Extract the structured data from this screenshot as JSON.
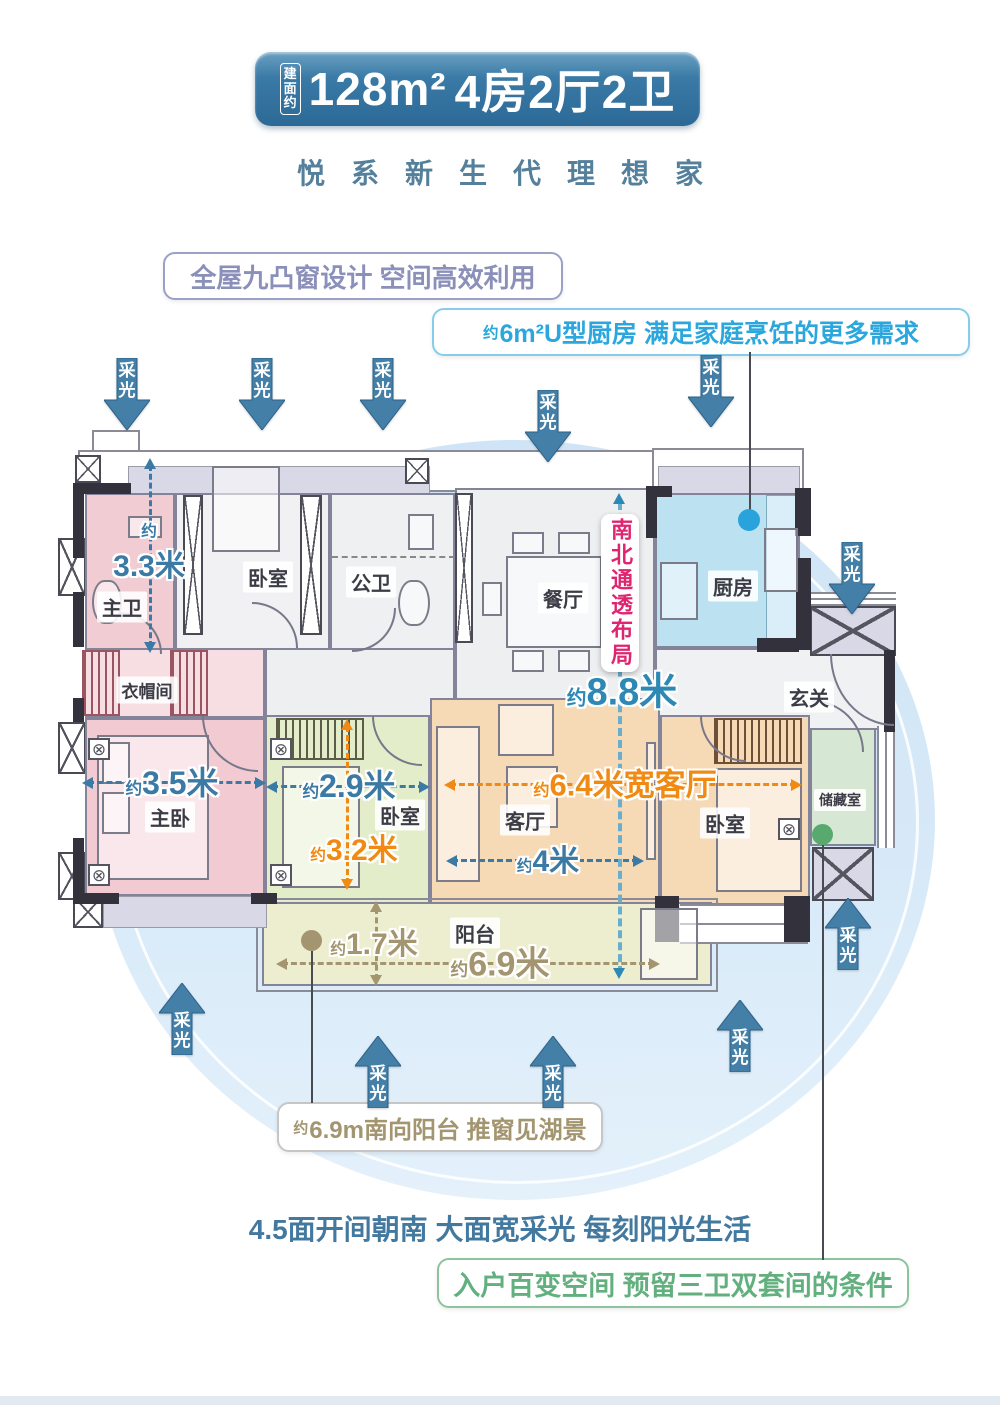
{
  "header": {
    "badge_prefix": "建面约",
    "badge_area": "128m²",
    "badge_suffix": "4房2厅2卫",
    "subtitle": "悦系新生代理想家"
  },
  "callouts": {
    "windows": "全屋九凸窗设计 空间高效利用",
    "kitchen_prefix": "约",
    "kitchen_text": "6m²U型厨房 满足家庭烹饪的更多需求",
    "ns_layout": "南北通透布局",
    "balcony_prefix": "约",
    "balcony_text": "6.9m南向阳台 推窗见湖景",
    "south": "4.5面开间朝南 大面宽采光 每刻阳光生活",
    "entry": "入户百变空间 预留三卫双套间的条件"
  },
  "daylight_label": "采光",
  "rooms": {
    "master_bath": "主卫",
    "cloakroom": "衣帽间",
    "master_bedroom": "主卧",
    "bedroom2": "卧室",
    "public_bath": "公卫",
    "dining": "餐厅",
    "kitchen": "厨房",
    "entry": "玄关",
    "bedroom3": "卧室",
    "living": "客厅",
    "bedroom4": "卧室",
    "storage": "储藏室",
    "balcony": "阳台"
  },
  "dimensions": {
    "d33": {
      "prefix": "约",
      "value": "3.3米"
    },
    "d35": {
      "prefix": "约",
      "value": "3.5米"
    },
    "d29": {
      "prefix": "约",
      "value": "2.9米"
    },
    "d32": {
      "prefix": "约",
      "value": "3.2米"
    },
    "d64": {
      "prefix": "约",
      "value": "6.4米宽客厅"
    },
    "d4": {
      "prefix": "约",
      "value": "4米"
    },
    "d88": {
      "prefix": "约",
      "value": "8.8米"
    },
    "d17": {
      "prefix": "约",
      "value": "1.7米"
    },
    "d69": {
      "prefix": "约",
      "value": "6.9米"
    }
  },
  "colors": {
    "badge_blue": "#2c6997",
    "subtitle_teal": "#55809b",
    "windows_purple": "#8b90bb",
    "kitchen_cyan": "#2ba7dd",
    "ns_red": "#e02570",
    "daylight_arrow": "#447fa7",
    "dim_blue": "#3b7aa5",
    "dim_orange": "#f08a12",
    "dim_teal": "#2d89b3",
    "dim_tan": "#a3956f",
    "south_blue": "#44799f",
    "entry_green": "#63b07f",
    "glow_blue": "#d2e5f5",
    "room_pink": "#f1cad2",
    "room_green": "#e4edca",
    "room_tan": "#f6d9b5",
    "room_kitchen_blue": "#bce1f1",
    "room_storage_green": "#d6e8d3",
    "room_balcony": "#ededcf"
  }
}
